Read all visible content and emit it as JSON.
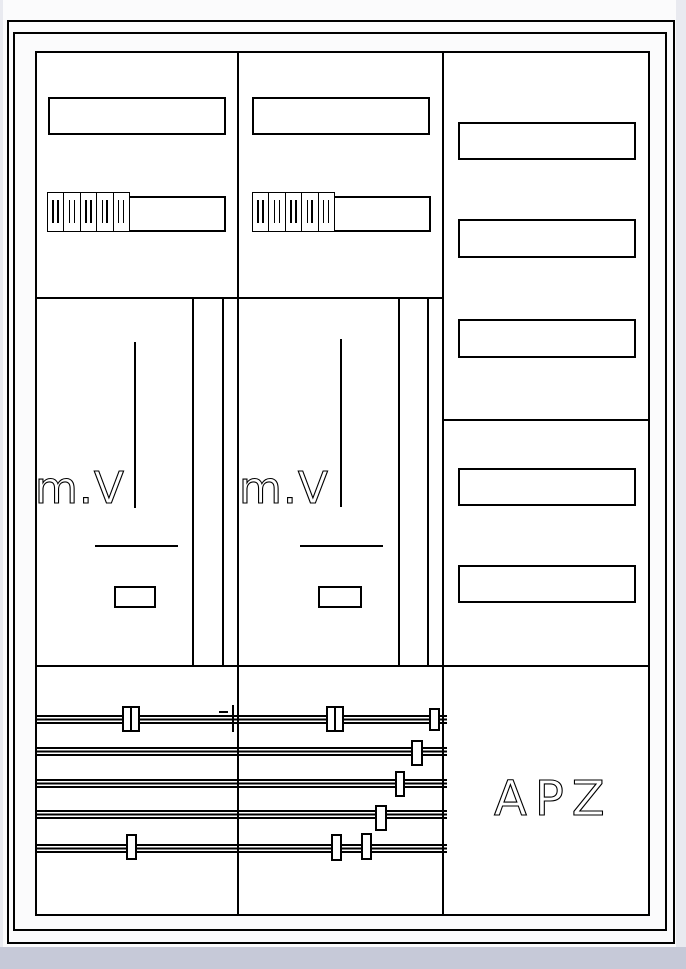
{
  "window": {
    "paper_color": "#ffffff",
    "line_color": "#000000",
    "chrome_bottom_color": "#c6c9d8",
    "chrome_side_color": "#e9eaf0"
  },
  "cabinet": {
    "meter_fields": [
      {
        "label": "m.V"
      },
      {
        "label": "m.V"
      }
    ],
    "apz_field": {
      "label": "APZ"
    },
    "breaker_modules_per_row": 5,
    "breaker_rows": 2,
    "busbar_count": 5,
    "blank_label_plates_top": 2,
    "blank_label_plates_right": 5
  }
}
